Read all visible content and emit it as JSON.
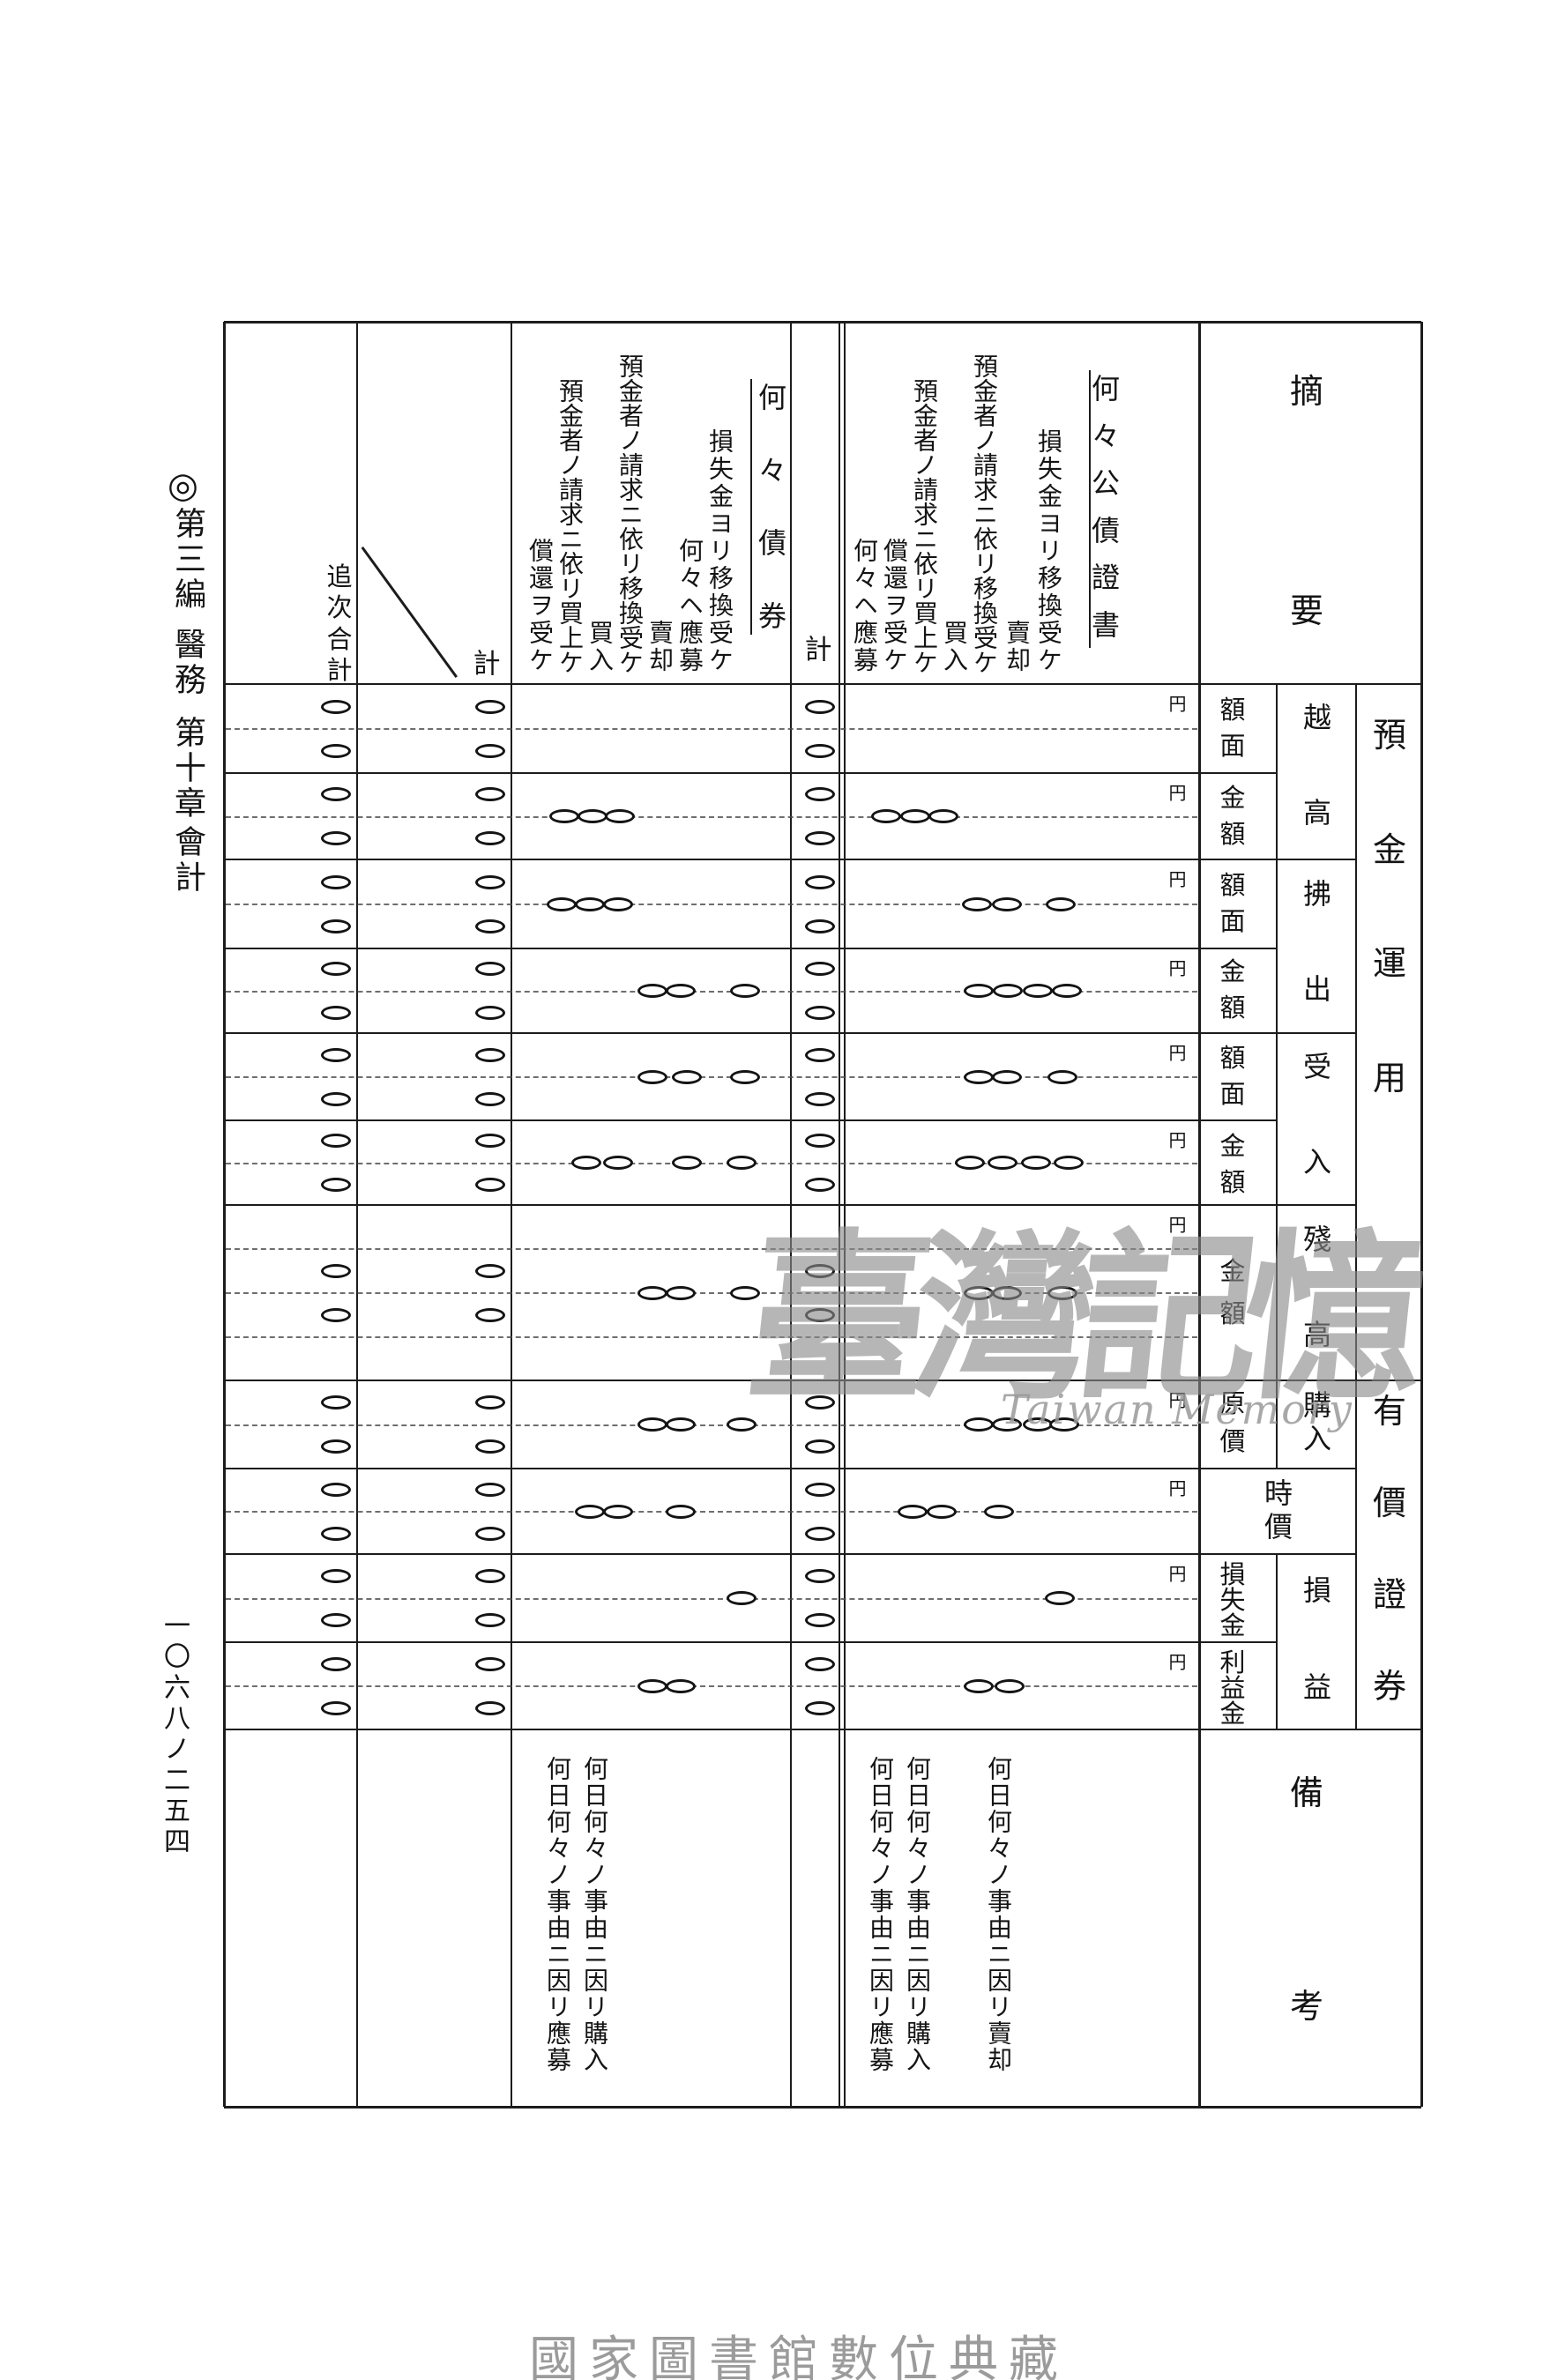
{
  "page": {
    "side_note": {
      "mark": "◎",
      "parts": [
        "第三編",
        "醫務",
        "第十章",
        "會計"
      ]
    },
    "page_number": "一〇六八ノ二五四",
    "footer": "國家圖書館數位典藏"
  },
  "watermark": {
    "text": "臺灣記憶",
    "subtext": "Taiwan Memory"
  },
  "table": {
    "summary_header": "摘要",
    "remarks_header": "備考",
    "unit": "円",
    "group_labels": [
      "預金運用",
      "有價證券"
    ],
    "amount_headers": [
      {
        "group": "越高",
        "cells": [
          "額面",
          "金額"
        ]
      },
      {
        "group": "拂出",
        "cells": [
          "額面",
          "金額"
        ]
      },
      {
        "group": "受入",
        "cells": [
          "額面",
          "金額"
        ]
      },
      {
        "group": "殘高",
        "cells": [
          "金額"
        ]
      },
      {
        "group": "購入",
        "cells": [
          "原價"
        ]
      },
      {
        "group": "時價",
        "cells": []
      },
      {
        "group": "損益",
        "cells": [
          "損失金",
          "利益金"
        ]
      }
    ],
    "sections": [
      {
        "title": "何々公債證書",
        "entries": [
          "損失金ヨリ移換受ケ",
          "賣却",
          "預金者ノ請求ニ依リ移換受ケ",
          "買入",
          "預金者ノ請求ニ依リ買上ケ",
          "償還ヲ受ケ",
          "何々ヘ應募"
        ],
        "remarks": [
          "何日何々ノ事由ニ因リ賣却",
          "何日何々ノ事由ニ因リ購入",
          "何日何々ノ事由ニ因リ應募"
        ]
      },
      {
        "title": "何々債券",
        "entries": [
          "損失金ヨリ移換受ケ",
          "何々ヘ應募",
          "賣却",
          "預金者ノ請求ニ依リ移換受ケ",
          "買入",
          "預金者ノ請求ニ依リ買上ケ",
          "償還ヲ受ケ"
        ],
        "remarks": [
          "何日何々ノ事由ニ因リ購入",
          "何日何々ノ事由ニ因リ應募"
        ]
      }
    ],
    "total_columns": {
      "section_total": "計",
      "grand_total": "計",
      "cumulative": "追次合計"
    },
    "marks": {
      "band_names": [
        "越高額面",
        "越高金額",
        "拂出額面",
        "拂出金額",
        "受入額面",
        "受入金額",
        "殘高金額",
        "購入原價",
        "時價",
        "損失金",
        "利益金"
      ],
      "total_columns_filled": true,
      "scattered": [
        [],
        [
          640,
          672,
          703,
          1005,
          1038,
          1070
        ],
        [
          637,
          669,
          701,
          1108,
          1142,
          1203
        ],
        [
          740,
          772,
          845,
          1110,
          1143,
          1177,
          1210
        ],
        [
          740,
          779,
          845,
          1110,
          1142,
          1205
        ],
        [
          665,
          701,
          779,
          841,
          1100,
          1137,
          1175,
          1212
        ],
        [
          740,
          772,
          845,
          1110,
          1142,
          1205
        ],
        [
          740,
          772,
          841,
          1110,
          1142,
          1177,
          1207
        ],
        [
          669,
          701,
          772,
          1035,
          1068,
          1133
        ],
        [
          841,
          1202
        ],
        [
          740,
          772,
          1110,
          1145
        ]
      ]
    }
  }
}
